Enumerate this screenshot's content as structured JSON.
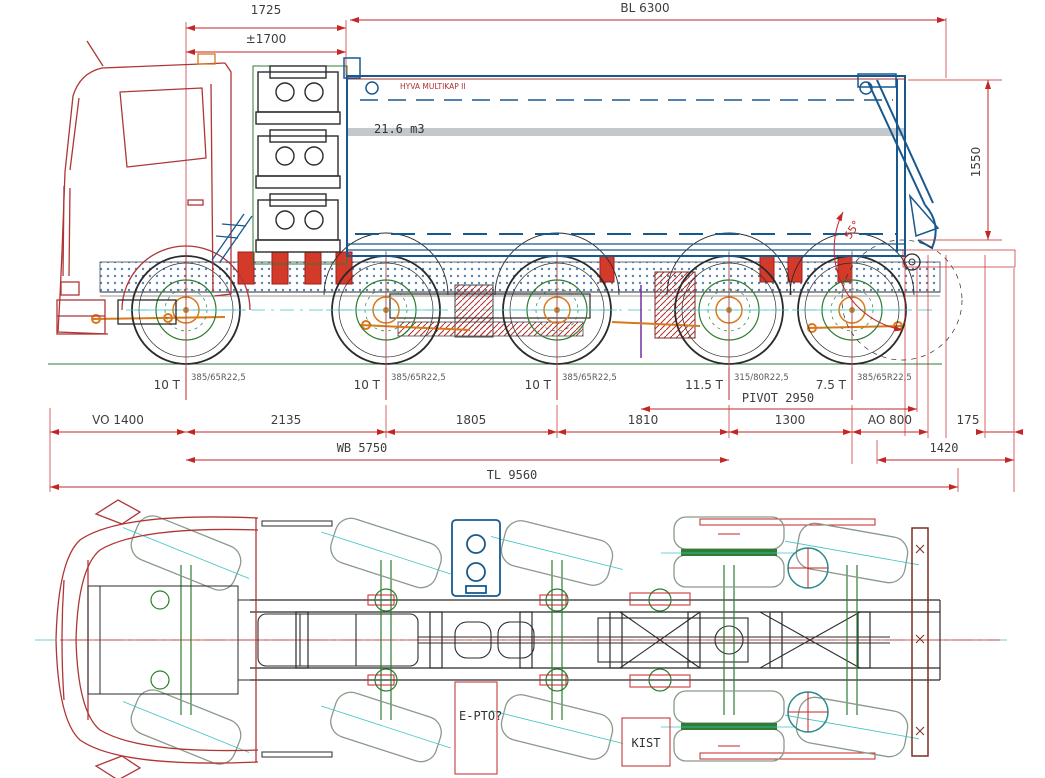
{
  "drawing": {
    "dims_top": {
      "d1725": "1725",
      "d1700": "±1700",
      "bl": "BL 6300",
      "h1550": "1550"
    },
    "body": {
      "brand_label": "HYVA MULTIKAP II",
      "volume": "21.6 m3",
      "tip_angle": "55°"
    },
    "axles": [
      {
        "load": "10 T",
        "tire": "385/65R22,5"
      },
      {
        "load": "10 T",
        "tire": "385/65R22,5"
      },
      {
        "load": "10 T",
        "tire": "385/65R22,5"
      },
      {
        "load": "11.5 T",
        "tire": "315/80R22,5"
      },
      {
        "load": "7.5 T",
        "tire": "385/65R22,5"
      }
    ],
    "dims_bottom": {
      "pivot": "PIVOT 2950",
      "row1": [
        "VO 1400",
        "2135",
        "1805",
        "1810",
        "1300",
        "AO 800",
        "175"
      ],
      "wb": "WB 5750",
      "rear": "1420",
      "tl": "TL 9560"
    },
    "top_view": {
      "pto_label": "E-PTO?",
      "kist_label": "KIST"
    }
  },
  "colors": {
    "dimension_red": "#c42525",
    "body_blue": "#17598f",
    "cab_red": "#b03535",
    "chassis_green": "#2e7d32",
    "detail_orange": "#d9791a",
    "centerline_cyan": "#3cc4c4",
    "pivot_purple": "#7030a0",
    "text_dark": "#3d3d3d"
  }
}
